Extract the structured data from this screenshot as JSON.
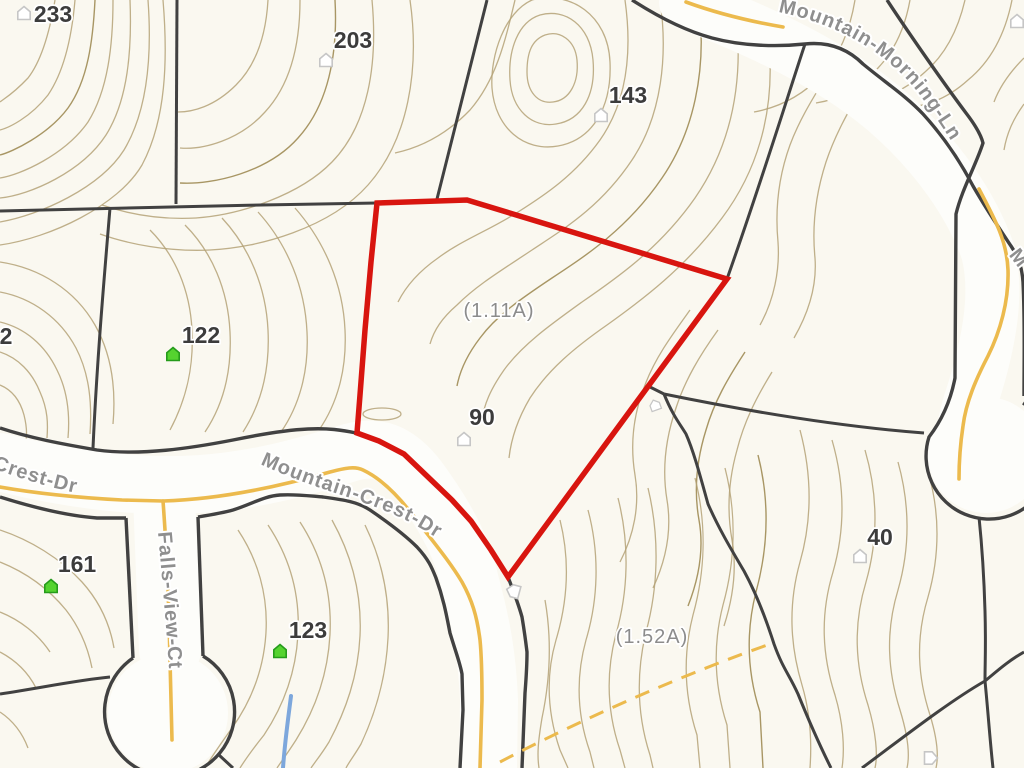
{
  "map": {
    "colors": {
      "bg": "#faf8f0",
      "road_fill": "#fdfdfa",
      "contour": "#b4a277",
      "contour_dark": "#a3905c",
      "boundary": "#414141",
      "centerline": "#ecba4d",
      "highlight": "#d8150f",
      "street_label": "#8f8f8f",
      "parcel_label": "#3c3c3c",
      "acreage_label": "#8c8c8c",
      "house_green": "#55d32f",
      "house_green_stroke": "#259b1b",
      "house_white_stroke": "#c6c6c6",
      "stream": "#7da7dc"
    },
    "streets": {
      "mountain_morning_ln": "Mountain-Morning-Ln",
      "mountain_crest_dr": "Mountain-Crest-Dr",
      "crest_dr_partial": "Crest-Dr",
      "falls_view_ct": "Falls-View-Ct"
    },
    "street_fragments": [
      {
        "text": "M",
        "x": 1014,
        "y": 262,
        "rot": 52
      }
    ],
    "highlighted_parcel": {
      "number": "90",
      "acreage": "(1.11A)"
    },
    "parcel_labels": [
      {
        "text": "233",
        "x": 53,
        "y": 22
      },
      {
        "text": "203",
        "x": 353,
        "y": 48
      },
      {
        "text": "143",
        "x": 628,
        "y": 103
      },
      {
        "text": "122",
        "x": 201,
        "y": 343
      },
      {
        "text": "2",
        "x": 6,
        "y": 344
      },
      {
        "text": "90",
        "x": 482,
        "y": 425
      },
      {
        "text": "161",
        "x": 77,
        "y": 572
      },
      {
        "text": "123",
        "x": 308,
        "y": 638
      },
      {
        "text": "40",
        "x": 880,
        "y": 545
      }
    ],
    "acreage_labels": [
      {
        "text": "(1.11A)",
        "x": 499,
        "y": 317
      },
      {
        "text": "(1.52A)",
        "x": 652,
        "y": 643
      }
    ],
    "houses": [
      {
        "x": 24,
        "y": 13,
        "variant": "white",
        "rot": 0
      },
      {
        "x": 326,
        "y": 60,
        "variant": "white",
        "rot": 0
      },
      {
        "x": 601,
        "y": 115,
        "variant": "white",
        "rot": 0
      },
      {
        "x": 1017,
        "y": 21,
        "variant": "white",
        "rot": 0
      },
      {
        "x": 173,
        "y": 354,
        "variant": "green",
        "rot": 0
      },
      {
        "x": 464,
        "y": 439,
        "variant": "white",
        "rot": 0
      },
      {
        "x": 51,
        "y": 586,
        "variant": "green",
        "rot": 0
      },
      {
        "x": 280,
        "y": 651,
        "variant": "green",
        "rot": 0
      },
      {
        "x": 860,
        "y": 556,
        "variant": "white",
        "rot": 0
      },
      {
        "x": 513,
        "y": 591,
        "variant": "white",
        "rot": -75
      },
      {
        "x": 655,
        "y": 405,
        "variant": "white",
        "rot": -20,
        "scale": 0.8
      },
      {
        "x": 931,
        "y": 758,
        "variant": "white",
        "rot": 90
      }
    ]
  }
}
